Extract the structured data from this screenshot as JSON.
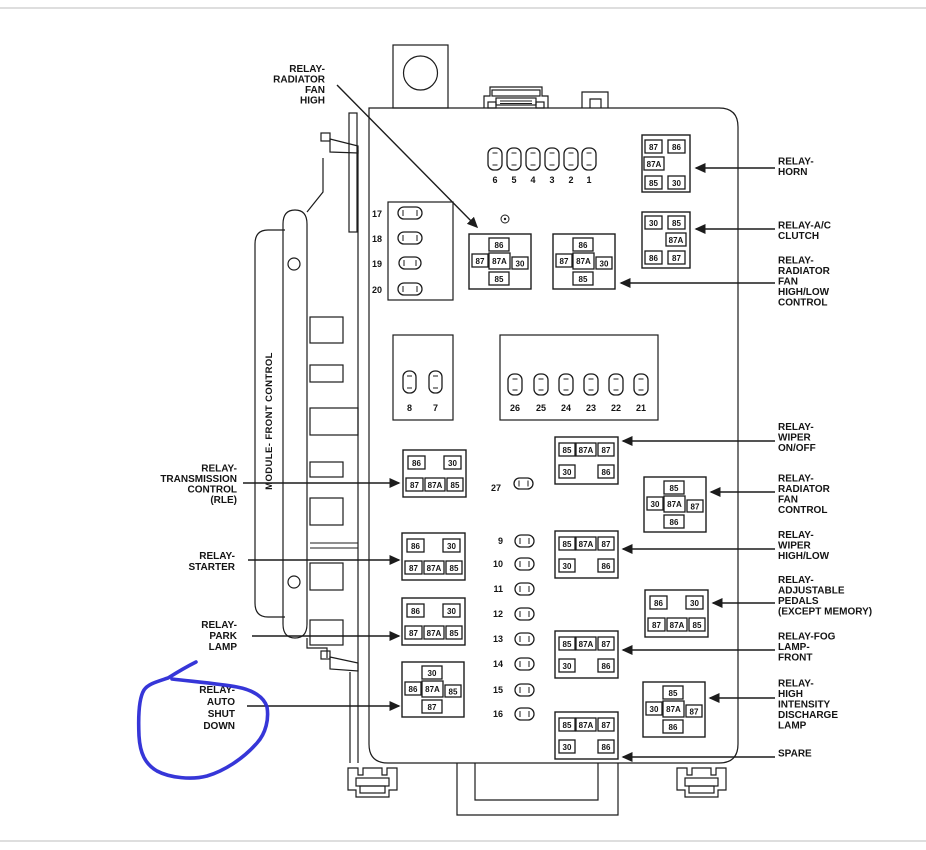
{
  "annotation": {
    "color": "#2b2bd6",
    "circled_label": "RELAY-AUTO SHUT DOWN"
  },
  "labels": {
    "module": "MODULE- FRONT CONTROL",
    "top_left": {
      "lines": [
        "RELAY-",
        "RADIATOR",
        "FAN",
        "HIGH"
      ]
    },
    "left": [
      {
        "lines": [
          "RELAY-",
          "TRANSMISSION",
          "CONTROL",
          "(RLE)"
        ]
      },
      {
        "lines": [
          "RELAY-",
          "STARTER"
        ]
      },
      {
        "lines": [
          "RELAY-",
          "PARK",
          "LAMP"
        ]
      },
      {
        "lines": [
          "RELAY-",
          "AUTO",
          "SHUT",
          "DOWN"
        ]
      }
    ],
    "right": [
      {
        "lines": [
          "RELAY-",
          "HORN"
        ]
      },
      {
        "lines": [
          "RELAY-A/C",
          "CLUTCH"
        ]
      },
      {
        "lines": [
          "RELAY-",
          "RADIATOR",
          "FAN",
          "HIGH/LOW",
          "CONTROL"
        ]
      },
      {
        "lines": [
          "RELAY-",
          "WIPER",
          "ON/OFF"
        ]
      },
      {
        "lines": [
          "RELAY-",
          "RADIATOR",
          "FAN",
          "CONTROL"
        ]
      },
      {
        "lines": [
          "RELAY-",
          "WIPER",
          "HIGH/LOW"
        ]
      },
      {
        "lines": [
          "RELAY-",
          "ADJUSTABLE",
          "PEDALS",
          "(EXCEPT MEMORY)"
        ]
      },
      {
        "lines": [
          "RELAY-FOG",
          "LAMP-",
          "FRONT"
        ]
      },
      {
        "lines": [
          "RELAY-",
          "HIGH",
          "INTENSITY",
          "DISCHARGE",
          "LAMP"
        ]
      },
      {
        "lines": [
          "SPARE"
        ]
      }
    ]
  },
  "fuses": {
    "row_top": [
      "6",
      "5",
      "4",
      "3",
      "2",
      "1"
    ],
    "block_17_20": [
      "17",
      "18",
      "19",
      "20"
    ],
    "pair_8_7": [
      "8",
      "7"
    ],
    "row_26_21": [
      "26",
      "25",
      "24",
      "23",
      "22",
      "21"
    ],
    "fuse_27": "27",
    "column_9_16": [
      "9",
      "10",
      "11",
      "12",
      "13",
      "14",
      "15",
      "16"
    ]
  },
  "relays": {
    "radiator_fan_high": {
      "pins": {
        "top": "86",
        "mid_left": "87",
        "mid_center": "87A",
        "mid_right": "30",
        "bottom": "85"
      }
    },
    "radiator_fan_high_low": {
      "pins": {
        "top": "86",
        "mid_left": "87",
        "mid_center": "87A",
        "mid_right": "30",
        "bottom": "85"
      }
    },
    "horn": {
      "pins": {
        "top_left": "87",
        "top_right": "86",
        "mid_left": "87A",
        "bottom_left": "85",
        "bottom_right": "30"
      }
    },
    "ac_clutch": {
      "pins": {
        "top_left": "30",
        "top_right": "85",
        "mid_right": "87A",
        "bottom_left": "86",
        "bottom_right": "87"
      }
    },
    "transmission": {
      "pins": {
        "top_left": "86",
        "top_right": "30",
        "bottom_left": "87",
        "bottom_mid": "87A",
        "bottom_right": "85"
      }
    },
    "starter": {
      "pins": {
        "top_left": "86",
        "top_right": "30",
        "bottom_left": "87",
        "bottom_mid": "87A",
        "bottom_right": "85"
      }
    },
    "park_lamp": {
      "pins": {
        "top_left": "86",
        "top_right": "30",
        "bottom_left": "87",
        "bottom_mid": "87A",
        "bottom_right": "85"
      }
    },
    "auto_shut_down": {
      "pins": {
        "top": "30",
        "mid_left": "86",
        "mid_center": "87A",
        "mid_right": "85",
        "bottom": "87"
      }
    },
    "wiper_on_off": {
      "pins": {
        "top_left": "85",
        "top_mid": "87A",
        "top_right": "87",
        "bottom_left": "30",
        "bottom_right": "86"
      }
    },
    "wiper_high_low": {
      "pins": {
        "top_left": "85",
        "top_mid": "87A",
        "top_right": "87",
        "bottom_left": "30",
        "bottom_right": "86"
      }
    },
    "fog_lamp_front": {
      "pins": {
        "top_left": "85",
        "top_mid": "87A",
        "top_right": "87",
        "bottom_left": "30",
        "bottom_right": "86"
      }
    },
    "spare": {
      "pins": {
        "top_left": "85",
        "top_mid": "87A",
        "top_right": "87",
        "bottom_left": "30",
        "bottom_right": "86"
      }
    },
    "radiator_fan_control": {
      "pins": {
        "top": "85",
        "mid_left": "30",
        "mid_center": "87A",
        "mid_right": "87",
        "bottom": "86"
      }
    },
    "adjustable_pedals": {
      "pins": {
        "top_left": "86",
        "top_right": "30",
        "bottom_left": "87",
        "bottom_mid": "87A",
        "bottom_right": "85"
      }
    },
    "hid": {
      "pins": {
        "top": "85",
        "mid_left": "30",
        "mid_center": "87A",
        "mid_right": "87",
        "bottom": "86"
      }
    }
  }
}
